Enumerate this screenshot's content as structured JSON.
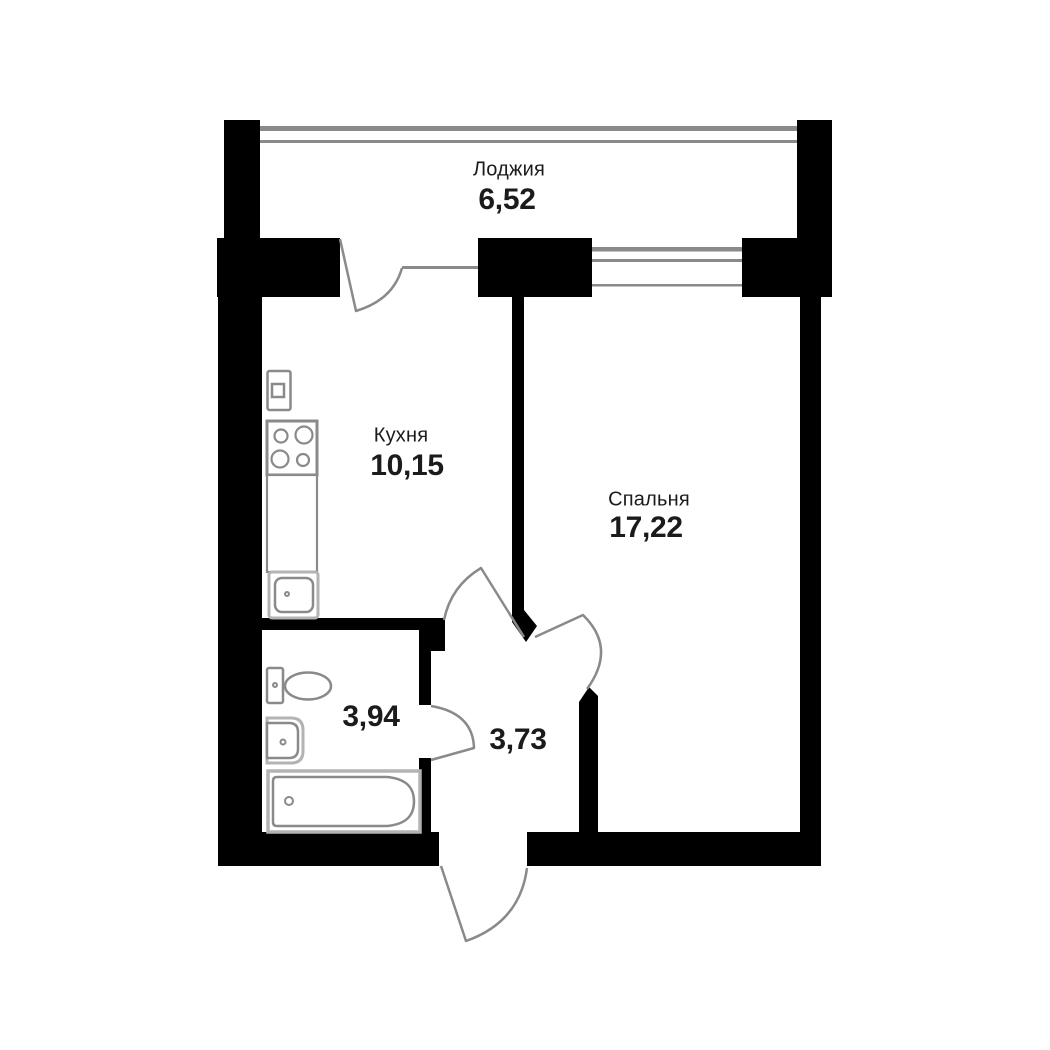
{
  "plan_title": "apartment-floor-plan",
  "rooms": {
    "loggia": {
      "name": "Лоджия",
      "area": "6,52"
    },
    "kitchen": {
      "name": "Кухня",
      "area": "10,15"
    },
    "bedroom": {
      "name": "Спальня",
      "area": "17,22"
    },
    "bathroom": {
      "area": "3,94"
    },
    "hallway": {
      "area": "3,73"
    }
  },
  "fixtures": [
    "washing-machine",
    "stove",
    "countertop",
    "kitchen-sink",
    "toilet",
    "bathroom-sink",
    "bathtub"
  ],
  "doors": [
    "loggia-door",
    "kitchen-door",
    "bedroom-door",
    "bathroom-door",
    "entrance-door"
  ],
  "windows": [
    "loggia-glazing",
    "bedroom-window"
  ],
  "colors": {
    "wall": "#000000",
    "line": "#8a8a8a",
    "line_light": "#b3b3b3",
    "text": "#1b1b1b",
    "background": "#ffffff"
  }
}
